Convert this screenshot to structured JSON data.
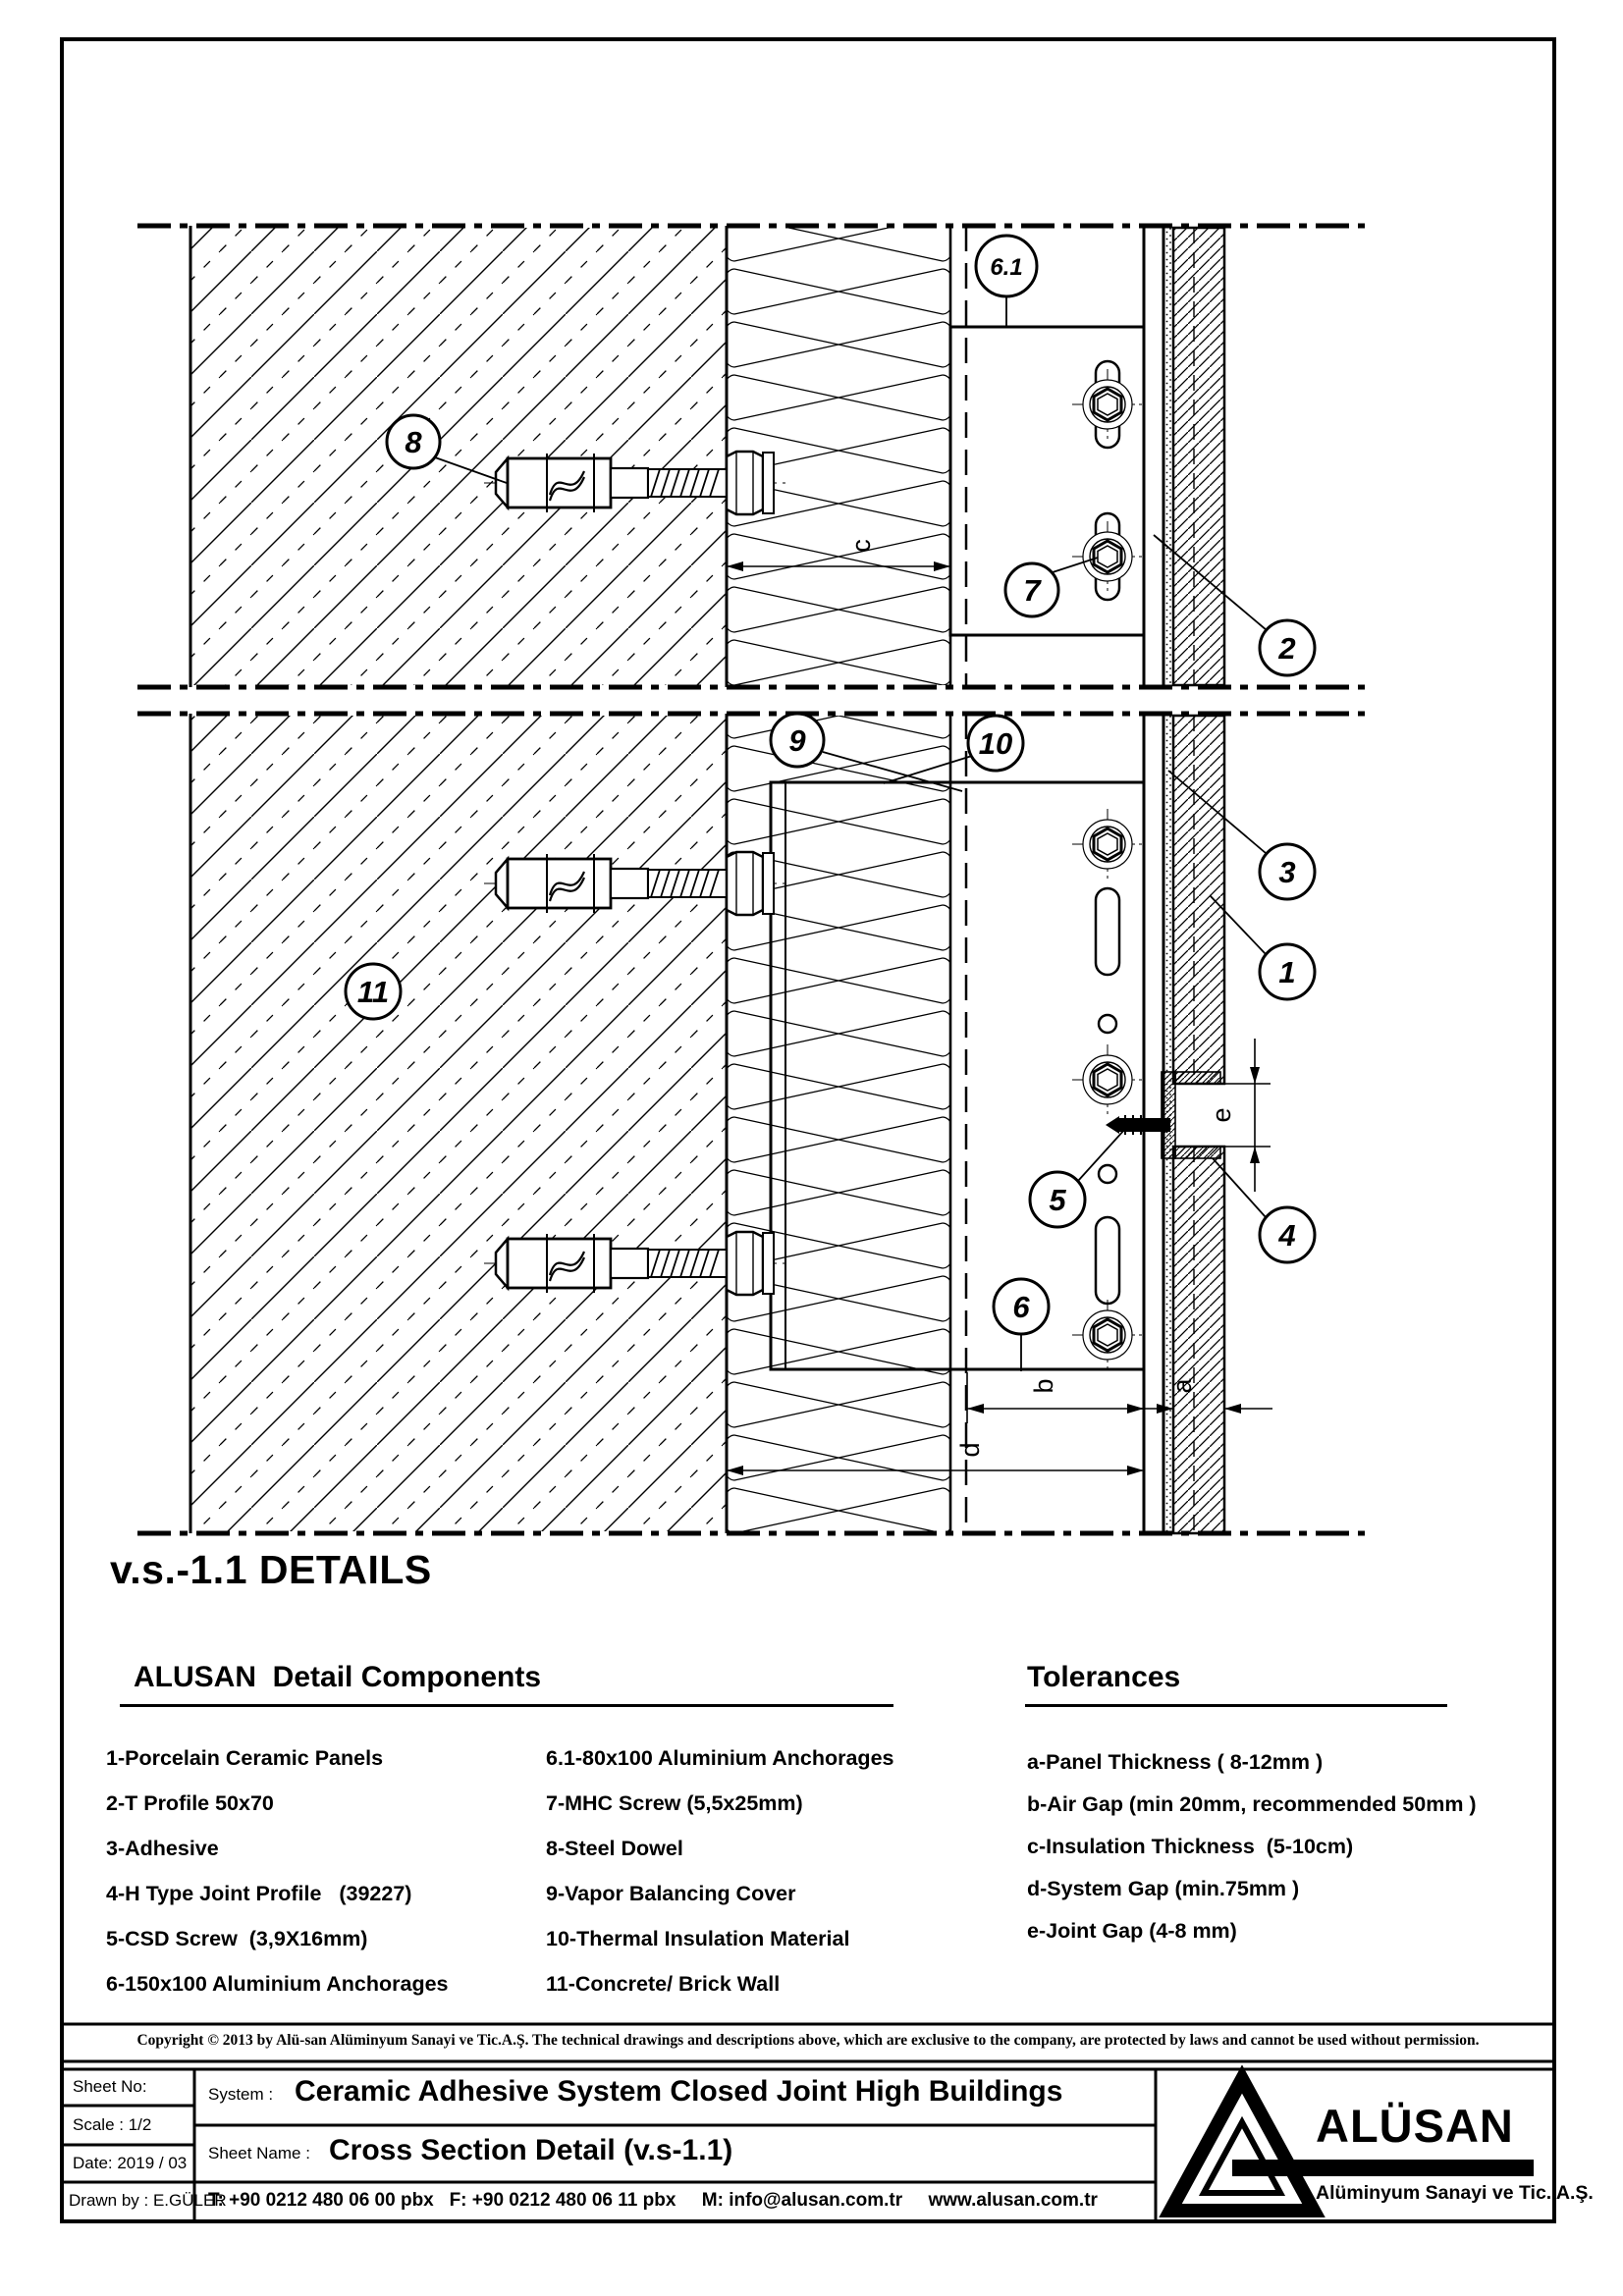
{
  "sheet": {
    "heading": "v.s.-1.1 DETAILS",
    "copyright": "Copyright © 2013 by Alü-san Alüminyum Sanayi ve Tic.A.Ş. The technical drawings and descriptions above, which are exclusive to the company, are protected by laws and cannot be used without permission."
  },
  "components": {
    "title": "ALUSAN  Detail Components",
    "col1": [
      "1-Porcelain Ceramic Panels",
      "2-T Profile 50x70",
      "3-Adhesive",
      "4-H Type Joint Profile   (39227)",
      "5-CSD Screw  (3,9X16mm)",
      "6-150x100 Aluminium Anchorages"
    ],
    "col2": [
      "6.1-80x100 Aluminium Anchorages",
      "7-MHC Screw (5,5x25mm)",
      "8-Steel Dowel",
      "9-Vapor Balancing Cover",
      "10-Thermal Insulation Material",
      "11-Concrete/ Brick Wall"
    ]
  },
  "tolerances": {
    "title": "Tolerances",
    "items": [
      "a-Panel Thickness ( 8-12mm )",
      "b-Air Gap (min 20mm, recommended 50mm )",
      "c-Insulation Thickness  (5-10cm)",
      "d-System Gap (min.75mm )",
      "e-Joint Gap (4-8 mm)"
    ]
  },
  "drawing": {
    "callouts": [
      "8",
      "6.1",
      "7",
      "2",
      "9",
      "10",
      "3",
      "1",
      "11",
      "5",
      "4",
      "6"
    ],
    "dims": {
      "a": "a",
      "b": "b",
      "c": "c",
      "d": "d",
      "e": "e"
    }
  },
  "title_block": {
    "sheet_no": "Sheet No:",
    "scale": "Scale : 1/2",
    "date": "Date: 2019 / 03",
    "drawn_by": "Drawn by : E.GÜLER",
    "system_label": "System :",
    "system_value": "Ceramic Adhesive System Closed Joint High Buildings",
    "sheet_name_label": "Sheet Name :",
    "sheet_name_value": "Cross Section Detail (v.s-1.1)",
    "contact": "T: +90 0212 480 06 00 pbx   F: +90 0212 480 06 11 pbx     M: info@alusan.com.tr     www.alusan.com.tr",
    "logo_text": "ALÜSAN",
    "logo_subtext": "Alüminyum Sanayi ve Tic. A.Ş."
  }
}
